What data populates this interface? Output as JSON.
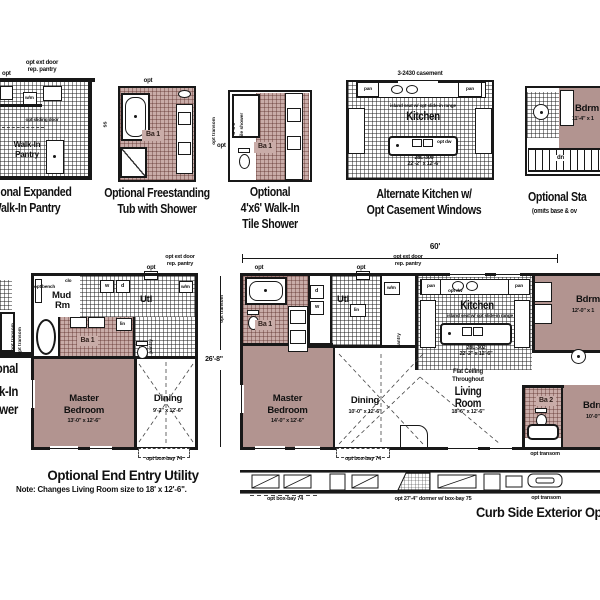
{
  "colors": {
    "wall": "#181818",
    "room_fill": "#b29490",
    "bath_tile": "#c9aca8",
    "paper": "#ffffff"
  },
  "p1": {
    "t1": "Optional Expanded",
    "t2": "Walk-In Pantry",
    "opt_ext": "opt ext door",
    "rep": "rep. pantry",
    "opt": "opt",
    "wm": "w/m",
    "slide": "opt sliding door",
    "walk": "Walk-In",
    "pantry": "Pantry"
  },
  "p2": {
    "t1": "Optional Freestanding",
    "t2": "Tub with Shower",
    "opt": "opt",
    "ss": "ss",
    "ba1": "Ba 1"
  },
  "p3": {
    "t1": "Optional",
    "t2": "4'x6' Walk-In",
    "t3": "Tile Shower",
    "transom": "opt transom",
    "opt": "opt",
    "sh1": "4' x 6'",
    "sh2": "tile shower",
    "ba1": "Ba 1"
  },
  "p4": {
    "t1": "Alternate Kitchen w/",
    "t2": "Opt Casement Windows",
    "casement": "3-2430 casement",
    "pan1": "pan",
    "pan2": "pan",
    "note": "island seat w/ opt slide-in range",
    "kitchen": "Kitchen",
    "dw": "opt dw",
    "model": "28L-300",
    "dim": "22'-2\" x 12'-6\""
  },
  "p5": {
    "t1": "Optional Sta",
    "t2": "(omits base & ov",
    "bdrm": "Bdrm",
    "dim": "11'-4\" x 1",
    "dn": "dn"
  },
  "frag": {
    "t1": "Optional",
    "t2": "Walk-In",
    "t3": "Shower",
    "transom": "opt transom"
  },
  "ee": {
    "title": "Optional End Entry Utility",
    "note": "Note: Changes Living Room size to 18' x 12'-6\".",
    "opt": "opt",
    "opt_ext": "opt ext door",
    "rep": "rep. pantry",
    "bench": "opt bench",
    "clo": "clo",
    "mud1": "Mud",
    "mud2": "Rm",
    "w": "w",
    "d": "d",
    "wm": "w/m",
    "utl": "Utl",
    "lin": "lin",
    "ba1": "Ba 1",
    "pantry": "pantry",
    "transom": "opt transom",
    "m1": "Master",
    "m2": "Bedroom",
    "mdim": "13'-0\" x 12'-6\"",
    "din": "Dining",
    "ddim": "9'-2\" x 12'-6\"",
    "bay": "opt box-bay 74"
  },
  "mp": {
    "w60": "60'",
    "d268": "26'-8\"",
    "transoml": "opt transom",
    "opt1": "opt",
    "ba1": "Ba 1",
    "d": "d",
    "w": "w",
    "utl": "Utl",
    "opt2": "opt",
    "opt_ext": "opt ext door",
    "rep": "rep. pantry",
    "wm": "w/m",
    "lin": "lin",
    "pantry": "pantry",
    "pan1": "pan",
    "pan2": "pan",
    "dw": "opt dw",
    "kitchen": "Kitchen",
    "note": "island seat w/ opt slide-in range",
    "model": "28L-302",
    "kdim": "22'-2\" x 12'-6\"",
    "bd1": "Bdrm",
    "bd1dim": "12'-0\" x 1",
    "ba2": "Ba 2",
    "bd2": "Bdrm",
    "bd2dim": "10'-0\"",
    "m1": "Master",
    "m2": "Bedroom",
    "mdim": "14'-0\" x 12'-6\"",
    "din": "Dining",
    "ddim": "10'-0\" x 12'-6\"",
    "fc1": "Flat Ceiling",
    "fc2": "Throughout",
    "lv1": "Living",
    "lv2": "Room",
    "lvdim": "18'-6\" x 12'-6\"",
    "bay": "opt box-bay 74",
    "transomb": "opt transom"
  },
  "ev": {
    "title": "Curb Side Exterior Option",
    "bay": "opt box-bay 74",
    "dormer": "opt 27'-4\" dormer w/ box-bay 75",
    "transom": "opt transom"
  }
}
